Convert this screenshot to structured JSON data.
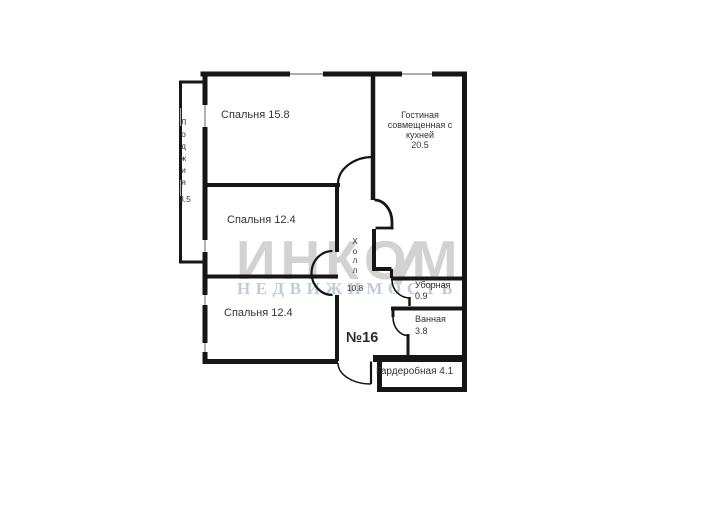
{
  "plan": {
    "apartment_number": "№16",
    "rooms": {
      "bedroom_top": {
        "label": "Спальня 15.8"
      },
      "living": {
        "line1": "Гостиная",
        "line2": "совмещенная с",
        "line3": "кухней",
        "area": "20.5"
      },
      "bedroom_middle": {
        "label": "Спальня 12.4"
      },
      "bedroom_bottom": {
        "label": "Спальня 12.4"
      },
      "loggia": {
        "name": "Лоджия",
        "area": "3.5"
      },
      "hall": {
        "name": "Холл",
        "area": "10.8"
      },
      "toilet": {
        "name": "Уборная",
        "area": "0.9"
      },
      "bathroom": {
        "name": "Ванная",
        "area": "3.8"
      },
      "wardrobe": {
        "label": "Гардеробная 4.1"
      }
    },
    "watermark": {
      "brand": "ИНКОМ",
      "subtitle": "НЕДВИЖИМОСТЬ"
    },
    "colors": {
      "wall": "#161616",
      "window_line": "#909090",
      "label": "#333333",
      "watermark_brand": "#d2d2d2",
      "watermark_subtitle": "#c0cbdb"
    }
  }
}
